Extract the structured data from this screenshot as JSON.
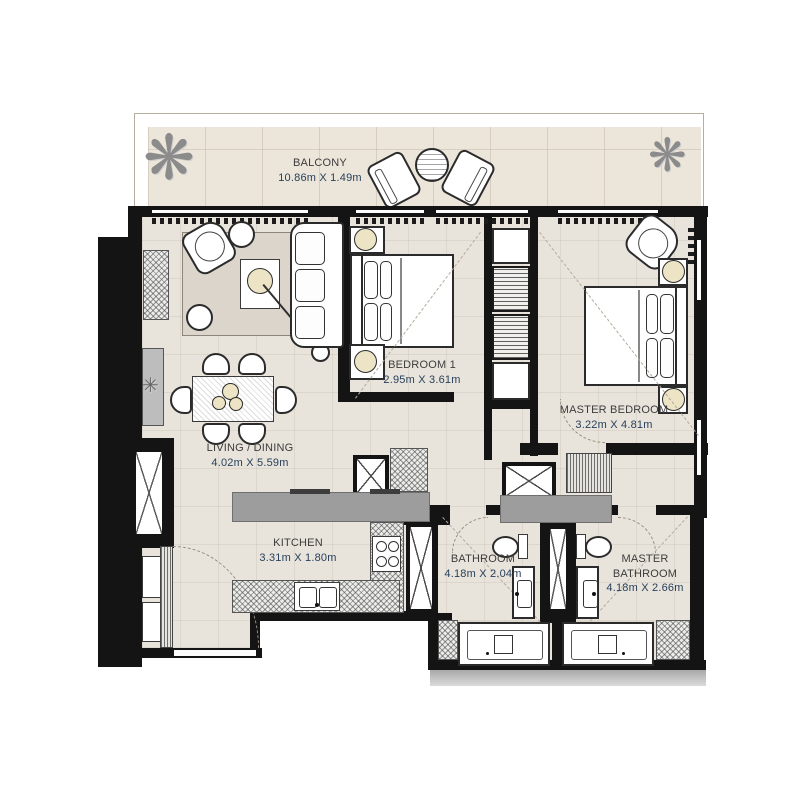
{
  "meta": {
    "type": "apartment-floor-plan",
    "bedrooms": 2
  },
  "colors": {
    "wall": "#141414",
    "floor": "#e9e4db",
    "balcony_floor": "#ece5da",
    "counter_gray": "#9d9d9d",
    "room_label_text": "#3c3c3c",
    "dimension_text": "#27405c"
  },
  "rooms": {
    "balcony": {
      "label": "BALCONY",
      "dims": "10.86m X 1.49m"
    },
    "living_dining": {
      "label": "LIVING / DINING",
      "dims": "4.02m X 5.59m"
    },
    "bedroom1": {
      "label": "BEDROOM 1",
      "dims": "2.95m X 3.61m"
    },
    "master_bedroom": {
      "label": "MASTER BEDROOM",
      "dims": "3.22m X 4.81m"
    },
    "kitchen": {
      "label": "KITCHEN",
      "dims": "3.31m X 1.80m"
    },
    "bathroom": {
      "label": "BATHROOM",
      "dims": "4.18m X 2.04m"
    },
    "master_bathroom": {
      "label": "MASTER BATHROOM",
      "dims": "4.18m X 2.66m"
    }
  },
  "icons": {
    "plant": "❋",
    "small_plant": "✳"
  }
}
